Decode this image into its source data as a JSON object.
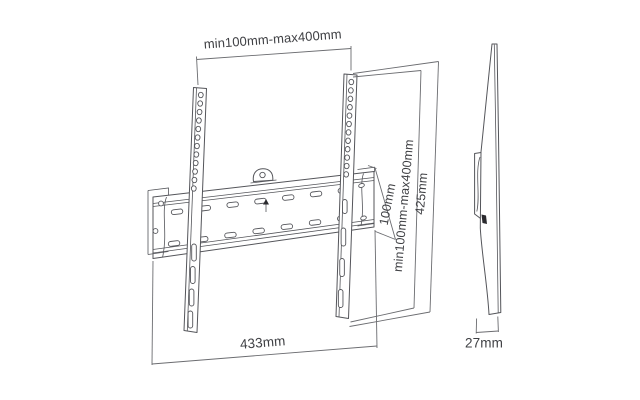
{
  "palette": {
    "background": "#ffffff",
    "line": "#54555a",
    "dimension_line": "#6b6c70",
    "text": "#3f4044",
    "dark_accent": "#2a2a2e"
  },
  "views": {
    "front": {
      "dims": {
        "top_width": "min100mm-max400mm",
        "plate_height": "100mm",
        "vertical_range": "min100mm-max400mm",
        "arm_height": "425mm",
        "plate_width": "433mm"
      }
    },
    "side": {
      "dims": {
        "depth": "27mm"
      }
    }
  }
}
